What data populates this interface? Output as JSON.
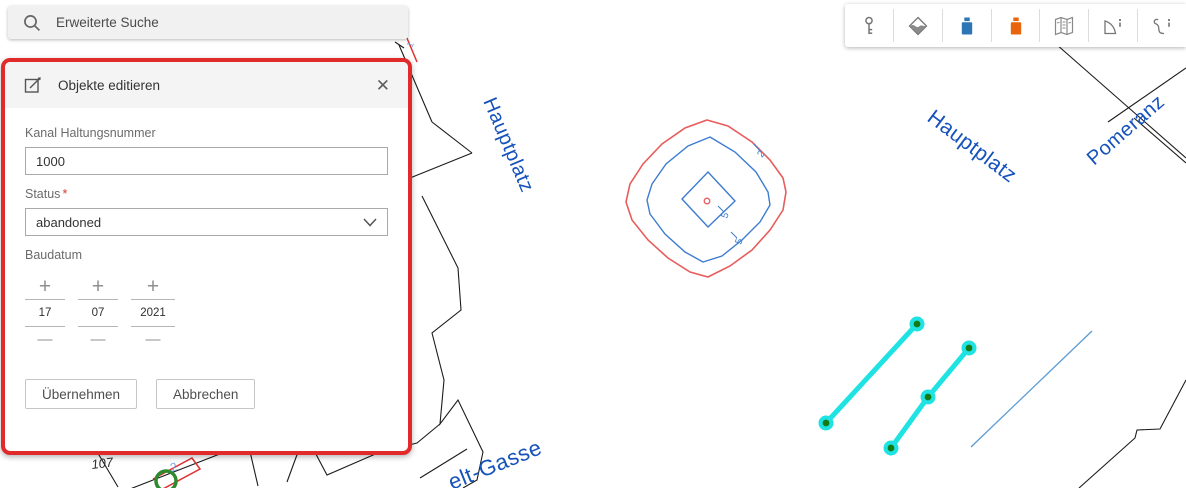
{
  "search": {
    "label": "Erweiterte Suche"
  },
  "edit_panel": {
    "title": "Objekte editieren",
    "close_label": "✕",
    "fields": {
      "kanal": {
        "label": "Kanal Haltungsnummer",
        "value": "1000"
      },
      "status": {
        "label": "Status",
        "required_mark": "*",
        "value": "abandoned"
      },
      "baudatum": {
        "label": "Baudatum",
        "plus_label": "+",
        "minus_label": "—",
        "parts": [
          {
            "value": "17"
          },
          {
            "value": "07"
          },
          {
            "value": "2021"
          }
        ]
      }
    },
    "buttons": {
      "apply_label": "Übernehmen",
      "cancel_label": "Abbrechen"
    }
  },
  "toolbar": {
    "tools": [
      {
        "icon": "key-icon"
      },
      {
        "icon": "basemap-icon"
      },
      {
        "icon": "point-symbol-blue-icon",
        "color": "#2e75b6"
      },
      {
        "icon": "point-symbol-orange-icon",
        "color": "#e8650d"
      },
      {
        "icon": "map-sheet-icon"
      },
      {
        "icon": "polygon-info-icon"
      },
      {
        "icon": "line-info-icon"
      }
    ]
  },
  "map": {
    "street_labels": [
      {
        "text": "Hauptplatz"
      },
      {
        "text": "Hauptplatz"
      },
      {
        "text": "Pomeranz"
      },
      {
        "text": "elt-Gasse"
      }
    ],
    "annotations": [
      {
        "text": "107"
      },
      {
        "text": "3"
      },
      {
        "text": "2"
      },
      {
        "text": "1"
      },
      {
        "text": "2"
      },
      {
        "text": "5"
      },
      {
        "text": "5"
      }
    ],
    "colors": {
      "street_label": "#1552bb",
      "parcel_line": "#1c1c1c",
      "contour_red": "#e85c5c",
      "contour_blue": "#3d7cd0",
      "edit_line": "#1fe3e3",
      "vertex_dot": "#157a15",
      "thin_line": "#5b9bd5",
      "highlight_red": "#e03030",
      "selection_green": "#2e8a2e",
      "tick_blue": "#7aa7e0"
    }
  }
}
